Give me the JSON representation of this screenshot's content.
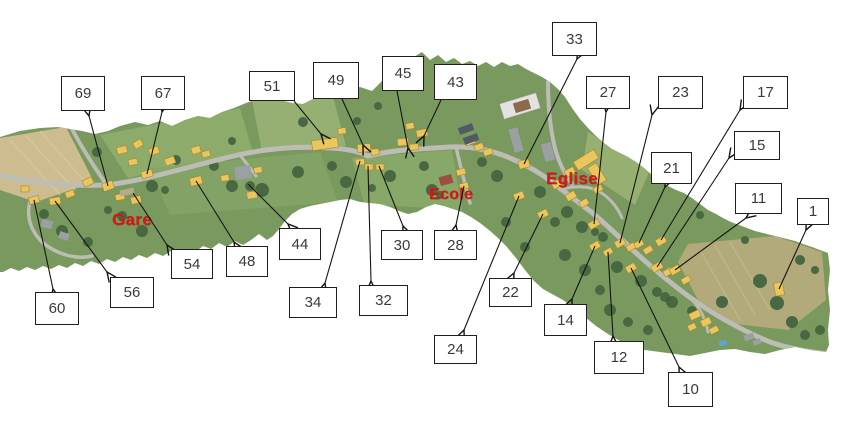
{
  "colors": {
    "background": "#ffffff",
    "box_border": "#1f1f1f",
    "box_text": "#3a3a3a",
    "arrow": "#151515",
    "place_label_red": "#d81714",
    "field_green": "#79995e",
    "field_tan": "#ccbc90",
    "road_gray": "#bdbdb5",
    "building_yellow": "#eac65e"
  },
  "map": {
    "place_labels": [
      {
        "id": "gare",
        "text": "Gare",
        "x": 112,
        "y": 210,
        "size": 17
      },
      {
        "id": "ecole",
        "text": "Ecole",
        "x": 429,
        "y": 186,
        "size": 16
      },
      {
        "id": "eglise",
        "text": "Eglise",
        "x": 546,
        "y": 169,
        "size": 17
      }
    ]
  },
  "annotations": [
    {
      "label": "69",
      "box": {
        "x": 61,
        "y": 76,
        "w": 44,
        "h": 35
      },
      "arrow": {
        "x1": 108,
        "y1": 186,
        "x2": 89,
        "y2": 116
      }
    },
    {
      "label": "67",
      "box": {
        "x": 141,
        "y": 76,
        "w": 44,
        "h": 34
      },
      "arrow": {
        "x1": 147,
        "y1": 174,
        "x2": 162,
        "y2": 112
      }
    },
    {
      "label": "51",
      "box": {
        "x": 249,
        "y": 71,
        "w": 46,
        "h": 30
      },
      "arrow": {
        "x1": 294,
        "y1": 101,
        "x2": 321,
        "y2": 134
      }
    },
    {
      "label": "49",
      "box": {
        "x": 313,
        "y": 62,
        "w": 46,
        "h": 37
      },
      "arrow": {
        "x1": 342,
        "y1": 99,
        "x2": 363,
        "y2": 145
      }
    },
    {
      "label": "45",
      "box": {
        "x": 382,
        "y": 56,
        "w": 42,
        "h": 35
      },
      "arrow": {
        "x1": 397,
        "y1": 91,
        "x2": 408,
        "y2": 148
      }
    },
    {
      "label": "43",
      "box": {
        "x": 434,
        "y": 64,
        "w": 43,
        "h": 36
      },
      "arrow": {
        "x1": 441,
        "y1": 100,
        "x2": 424,
        "y2": 136
      }
    },
    {
      "label": "33",
      "box": {
        "x": 552,
        "y": 22,
        "w": 45,
        "h": 34
      },
      "arrow": {
        "x1": 524,
        "y1": 164,
        "x2": 577,
        "y2": 59
      }
    },
    {
      "label": "27",
      "box": {
        "x": 586,
        "y": 76,
        "w": 44,
        "h": 33
      },
      "arrow": {
        "x1": 594,
        "y1": 224,
        "x2": 606,
        "y2": 112
      }
    },
    {
      "label": "23",
      "box": {
        "x": 658,
        "y": 76,
        "w": 45,
        "h": 33
      },
      "arrow": {
        "x1": 620,
        "y1": 243,
        "x2": 652,
        "y2": 115
      }
    },
    {
      "label": "17",
      "box": {
        "x": 743,
        "y": 76,
        "w": 45,
        "h": 33
      },
      "arrow": {
        "x1": 661,
        "y1": 240,
        "x2": 740,
        "y2": 110
      }
    },
    {
      "label": "15",
      "box": {
        "x": 734,
        "y": 131,
        "w": 46,
        "h": 29
      },
      "arrow": {
        "x1": 657,
        "y1": 267,
        "x2": 729,
        "y2": 158
      }
    },
    {
      "label": "21",
      "box": {
        "x": 651,
        "y": 152,
        "w": 41,
        "h": 32
      },
      "arrow": {
        "x1": 639,
        "y1": 243,
        "x2": 665,
        "y2": 187
      }
    },
    {
      "label": "11",
      "box": {
        "x": 735,
        "y": 183,
        "w": 47,
        "h": 31
      },
      "arrow": {
        "x1": 675,
        "y1": 270,
        "x2": 746,
        "y2": 218
      }
    },
    {
      "label": "1",
      "box": {
        "x": 797,
        "y": 198,
        "w": 32,
        "h": 27
      },
      "arrow": {
        "x1": 779,
        "y1": 289,
        "x2": 806,
        "y2": 230
      }
    },
    {
      "label": "60",
      "box": {
        "x": 35,
        "y": 292,
        "w": 44,
        "h": 33
      },
      "arrow": {
        "x1": 34,
        "y1": 200,
        "x2": 53,
        "y2": 289
      }
    },
    {
      "label": "56",
      "box": {
        "x": 110,
        "y": 277,
        "w": 44,
        "h": 31
      },
      "arrow": {
        "x1": 55,
        "y1": 201,
        "x2": 107,
        "y2": 272
      }
    },
    {
      "label": "54",
      "box": {
        "x": 171,
        "y": 249,
        "w": 42,
        "h": 30
      },
      "arrow": {
        "x1": 133,
        "y1": 193,
        "x2": 167,
        "y2": 245
      }
    },
    {
      "label": "48",
      "box": {
        "x": 226,
        "y": 246,
        "w": 42,
        "h": 31
      },
      "arrow": {
        "x1": 196,
        "y1": 181,
        "x2": 234,
        "y2": 242
      }
    },
    {
      "label": "44",
      "box": {
        "x": 279,
        "y": 228,
        "w": 42,
        "h": 32
      },
      "arrow": {
        "x1": 248,
        "y1": 184,
        "x2": 288,
        "y2": 224
      }
    },
    {
      "label": "34",
      "box": {
        "x": 289,
        "y": 287,
        "w": 48,
        "h": 31
      },
      "arrow": {
        "x1": 360,
        "y1": 161,
        "x2": 325,
        "y2": 283
      }
    },
    {
      "label": "32",
      "box": {
        "x": 359,
        "y": 285,
        "w": 49,
        "h": 31
      },
      "arrow": {
        "x1": 368,
        "y1": 166,
        "x2": 371,
        "y2": 281
      }
    },
    {
      "label": "30",
      "box": {
        "x": 381,
        "y": 230,
        "w": 42,
        "h": 30
      },
      "arrow": {
        "x1": 379,
        "y1": 166,
        "x2": 403,
        "y2": 226
      }
    },
    {
      "label": "28",
      "box": {
        "x": 434,
        "y": 230,
        "w": 43,
        "h": 30
      },
      "arrow": {
        "x1": 464,
        "y1": 186,
        "x2": 456,
        "y2": 225
      }
    },
    {
      "label": "24",
      "box": {
        "x": 434,
        "y": 335,
        "w": 43,
        "h": 29
      },
      "arrow": {
        "x1": 519,
        "y1": 196,
        "x2": 464,
        "y2": 330
      }
    },
    {
      "label": "22",
      "box": {
        "x": 489,
        "y": 278,
        "w": 43,
        "h": 29
      },
      "arrow": {
        "x1": 543,
        "y1": 214,
        "x2": 514,
        "y2": 273
      }
    },
    {
      "label": "14",
      "box": {
        "x": 544,
        "y": 304,
        "w": 43,
        "h": 32
      },
      "arrow": {
        "x1": 595,
        "y1": 246,
        "x2": 572,
        "y2": 299
      }
    },
    {
      "label": "12",
      "box": {
        "x": 594,
        "y": 341,
        "w": 50,
        "h": 33
      },
      "arrow": {
        "x1": 608,
        "y1": 252,
        "x2": 613,
        "y2": 336
      }
    },
    {
      "label": "10",
      "box": {
        "x": 668,
        "y": 372,
        "w": 45,
        "h": 35
      },
      "arrow": {
        "x1": 631,
        "y1": 268,
        "x2": 679,
        "y2": 367
      }
    }
  ]
}
